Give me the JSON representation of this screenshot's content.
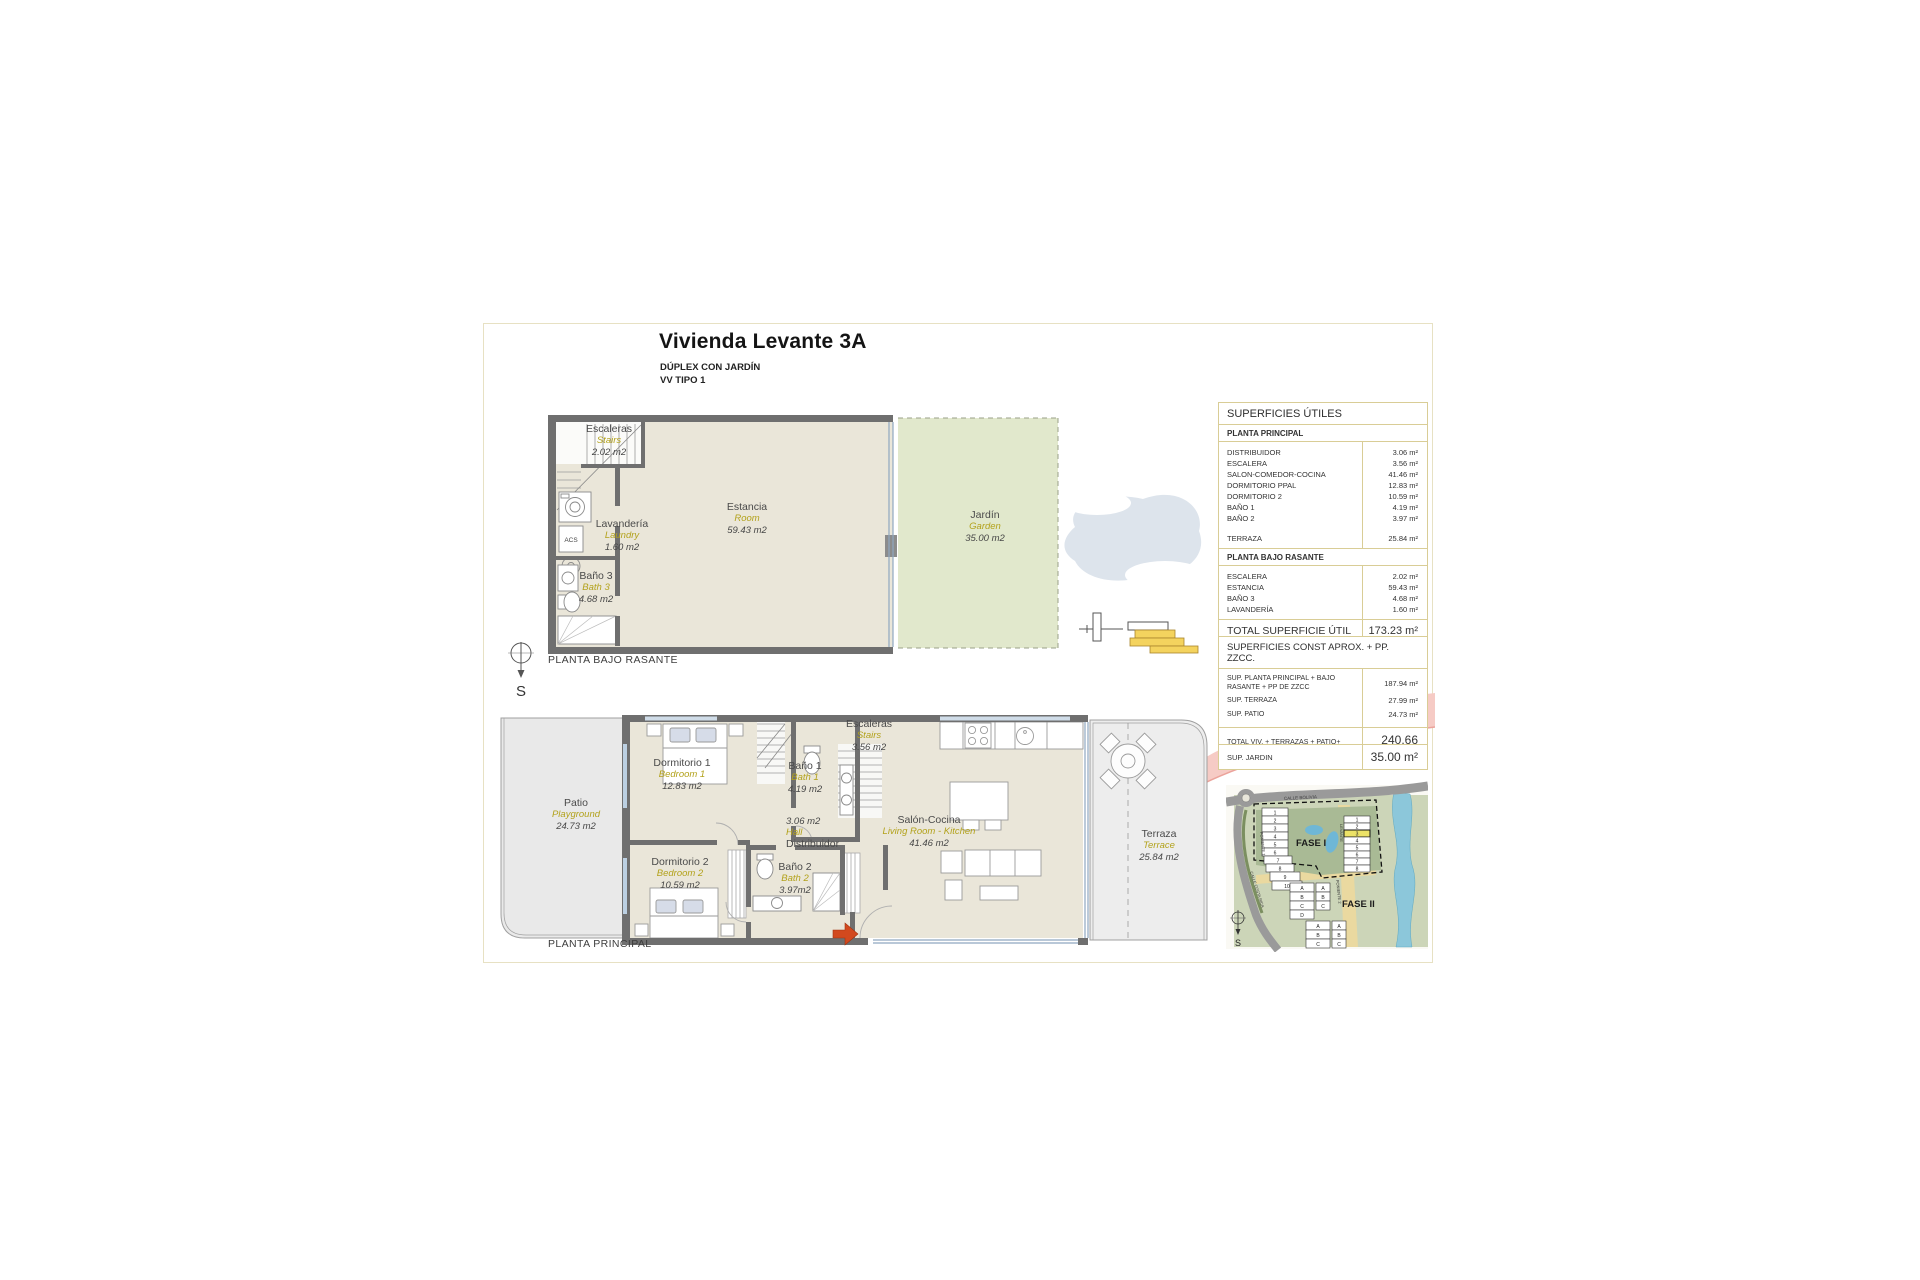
{
  "sheet": {
    "title": "Vivienda Levante 3A",
    "subtitle_line1": "DÚPLEX CON JARDÍN",
    "subtitle_line2": "VV TIPO 1"
  },
  "compass_s": "S",
  "upper_plan": {
    "caption": "PLANTA BAJO RASANTE",
    "acs_label": "ACS",
    "rooms": {
      "escaleras": {
        "name": "Escaleras",
        "en": "Stairs",
        "area": "2.02 m2"
      },
      "lavanderia": {
        "name": "Lavandería",
        "en": "Laundry",
        "area": "1.60 m2"
      },
      "bano3": {
        "name": "Baño 3",
        "en": "Bath 3",
        "area": "4.68 m2"
      },
      "estancia": {
        "name": "Estancia",
        "en": "Room",
        "area": "59.43 m2"
      },
      "jardin": {
        "name": "Jardín",
        "en": "Garden",
        "area": "35.00 m2"
      }
    }
  },
  "lower_plan": {
    "caption": "PLANTA PRINCIPAL",
    "rooms": {
      "dorm1": {
        "name": "Dormitorio 1",
        "en": "Bedroom 1",
        "area": "12.83 m2"
      },
      "bano1": {
        "name": "Baño 1",
        "en": "Bath 1",
        "area": "4.19 m2"
      },
      "escaleras": {
        "name": "Escaleras",
        "en": "Stairs",
        "area": "3.56 m2"
      },
      "distribuidor": {
        "name": "Distribuidor",
        "en": "Hall",
        "area": "3.06 m2"
      },
      "dorm2": {
        "name": "Dormitorio 2",
        "en": "Bedroom 2",
        "area": "10.59 m2"
      },
      "bano2": {
        "name": "Baño 2",
        "en": "Bath 2",
        "area": "3.97m2"
      },
      "salon": {
        "name": "Salón-Cocina",
        "en": "Living Room - Kitchen",
        "area": "41.46 m2"
      },
      "patio": {
        "name": "Patio",
        "en": "Playground",
        "area": "24.73 m2"
      },
      "terraza": {
        "name": "Terraza",
        "en": "Terrace",
        "area": "25.84 m2"
      }
    }
  },
  "tables": {
    "utiles": {
      "title": "SUPERFICIES ÚTILES",
      "section1": "PLANTA PRINCIPAL",
      "s1_rows": [
        {
          "n": "DISTRIBUIDOR",
          "v": "3.06 m²"
        },
        {
          "n": "ESCALERA",
          "v": "3.56 m²"
        },
        {
          "n": "SALON-COMEDOR-COCINA",
          "v": "41.46 m²"
        },
        {
          "n": "DORMITORIO PPAL",
          "v": "12.83 m²"
        },
        {
          "n": "DORMITORIO 2",
          "v": "10.59 m²"
        },
        {
          "n": "BAÑO 1",
          "v": "4.19 m²"
        },
        {
          "n": "BAÑO 2",
          "v": "3.97 m²"
        }
      ],
      "terraza_row": {
        "n": "TERRAZA",
        "v": "25.84 m²"
      },
      "section2": "PLANTA BAJO RASANTE",
      "s2_rows": [
        {
          "n": "ESCALERA",
          "v": "2.02 m²"
        },
        {
          "n": "ESTANCIA",
          "v": "59.43 m²"
        },
        {
          "n": "BAÑO 3",
          "v": "4.68 m²"
        },
        {
          "n": "LAVANDERÍA",
          "v": "1.60 m²"
        }
      ],
      "total": {
        "n": "TOTAL SUPERFICIE ÚTIL",
        "v": "173.23 m²"
      }
    },
    "superficies_const": {
      "title": "SUPERFICIES CONST APROX. + PP. ZZCC.",
      "rows": [
        {
          "n": "SUP. PLANTA PRINCIPAL + BAJO RASANTE + PP DE ZZCC",
          "v": "187.94 m²"
        },
        {
          "n": "SUP. TERRAZA",
          "v": "27.99 m²"
        },
        {
          "n": "SUP. PATIO",
          "v": "24.73 m²"
        }
      ],
      "total": {
        "n": "TOTAL VIV. + TERRAZAS + PATIO+ ZZCC",
        "v": "240.66 m²"
      }
    },
    "jardin_row": {
      "n": "SUP. JARDIN",
      "v": "35.00 m²"
    }
  },
  "site_map": {
    "fase1": "FASE I",
    "fase2": "FASE II",
    "street_top": "CALLE BOLIVIA",
    "street_left": "CALLE COSTA RICA",
    "bld_levante": "LEVANTE",
    "bld_poniente1": "PONIENTE 1",
    "bld_poniente2": "PONIENTE 2",
    "left_units": [
      "1",
      "2",
      "3",
      "4",
      "5",
      "6",
      "7",
      "8",
      "9",
      "10"
    ],
    "right_units": [
      "1",
      "2",
      "3",
      "4",
      "5",
      "6",
      "7",
      "8"
    ],
    "letters4": [
      "A",
      "B",
      "C",
      "D"
    ],
    "letters3": [
      "A",
      "B",
      "C"
    ]
  },
  "colors": {
    "accent_yellow": "#b3a21c",
    "table_border": "#d9cd96",
    "wall": "#6f6f6f",
    "floor": "#eae6d9",
    "garden": "#e1e8cc",
    "highlight_unit": "#ece267",
    "entry_arrow": "#d2491e",
    "pink_band": "#f6cbc5"
  }
}
